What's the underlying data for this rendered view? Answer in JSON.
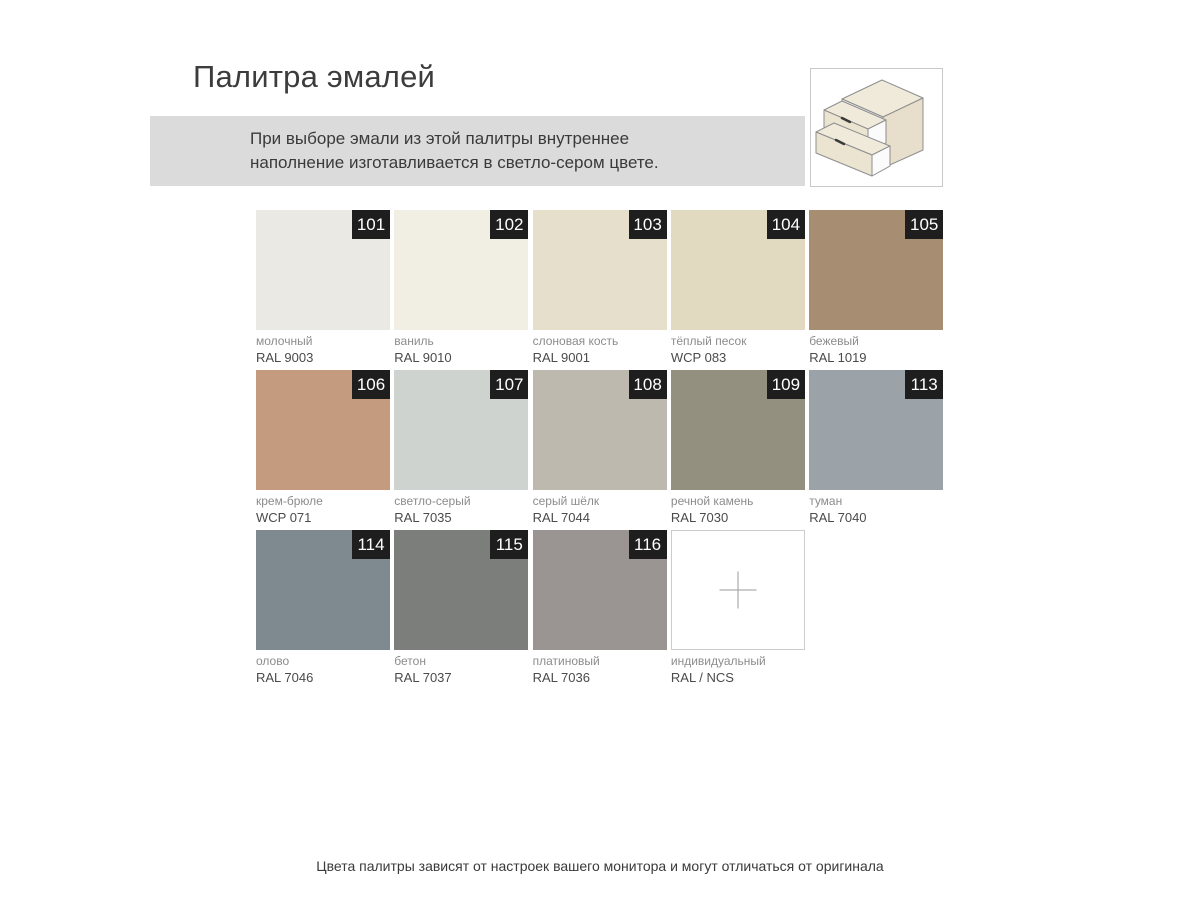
{
  "page": {
    "title": "Палитра эмалей",
    "note_line1": "При выборе эмали из этой палитры внутреннее",
    "note_line2": "наполнение изготавливается в светло-сером цвете.",
    "footer": "Цвета палитры зависят от настроек вашего монитора и могут отличаться от оригинала"
  },
  "legend_icon": "drawer-unit-icon",
  "colors": {
    "banner_bg": "#DBDBDB",
    "badge_bg": "#1E1E1E",
    "badge_text": "#FFFFFF",
    "custom_tile_border": "#CCCCCC",
    "icon_box_border": "#C9C9C9"
  },
  "swatches": [
    {
      "num": "101",
      "name": "молочный",
      "code": "RAL 9003",
      "color": "#EAE9E4",
      "custom": false
    },
    {
      "num": "102",
      "name": "ваниль",
      "code": "RAL 9010",
      "color": "#F1EFE4",
      "custom": false
    },
    {
      "num": "103",
      "name": "слоновая кость",
      "code": "RAL 9001",
      "color": "#E6DFCB",
      "custom": false
    },
    {
      "num": "104",
      "name": "тёплый песок",
      "code": "WCP 083",
      "color": "#E2D9C1",
      "custom": false
    },
    {
      "num": "105",
      "name": "бежевый",
      "code": "RAL 1019",
      "color": "#A78D71",
      "custom": false
    },
    {
      "num": "106",
      "name": "крем-брюле",
      "code": "WCP 071",
      "color": "#C59B7F",
      "custom": false
    },
    {
      "num": "107",
      "name": "светло-серый",
      "code": "RAL 7035",
      "color": "#CED3D0",
      "custom": false
    },
    {
      "num": "108",
      "name": "серый шёлк",
      "code": "RAL 7044",
      "color": "#BDB9AE",
      "custom": false
    },
    {
      "num": "109",
      "name": "речной камень",
      "code": "RAL 7030",
      "color": "#93907F",
      "custom": false
    },
    {
      "num": "113",
      "name": "туман",
      "code": "RAL 7040",
      "color": "#9CA3A8",
      "custom": false
    },
    {
      "num": "114",
      "name": "олово",
      "code": "RAL 7046",
      "color": "#7E8A90",
      "custom": false
    },
    {
      "num": "115",
      "name": "бетон",
      "code": "RAL 7037",
      "color": "#7C7E7C",
      "custom": false
    },
    {
      "num": "116",
      "name": "платиновый",
      "code": "RAL 7036",
      "color": "#9A9593",
      "custom": false
    },
    {
      "num": "",
      "name": "индивидуальный",
      "code": "RAL / NCS",
      "color": "#FFFFFF",
      "custom": true
    }
  ]
}
